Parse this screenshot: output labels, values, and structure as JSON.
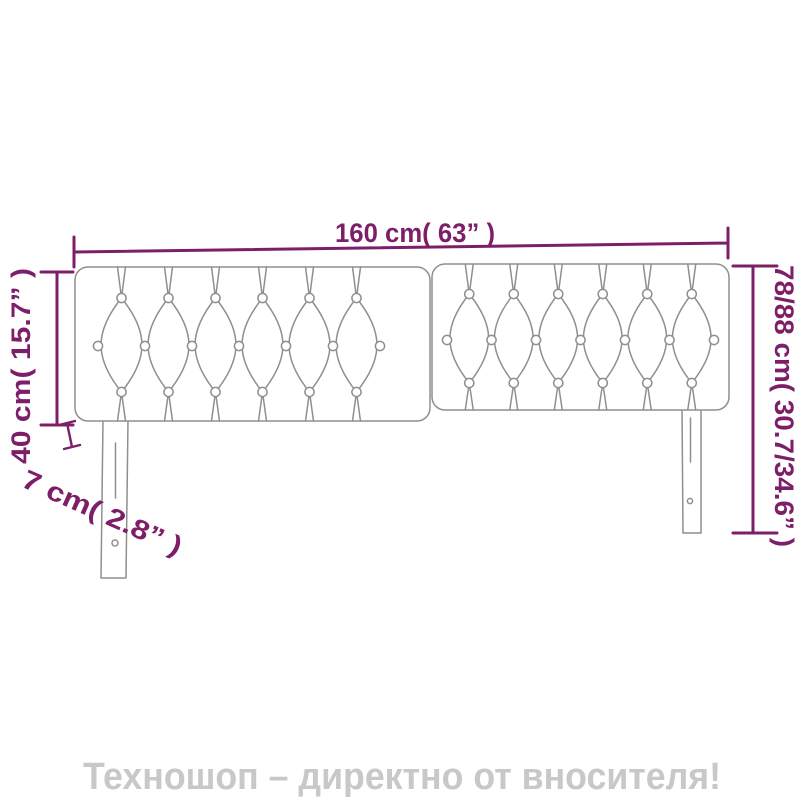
{
  "dimensions": {
    "width_label": "160 cm( 63” )",
    "height_label": "78/88 cm( 30.7/34.6” )",
    "panel_height_label": "40 cm( 15.7” )",
    "depth_label": "7 cm( 2.8” )"
  },
  "watermark": {
    "text": "Техношоп – директно от вносителя!"
  },
  "colors": {
    "dimension_accent": "#7D1E69",
    "drawing_line": "#8F8F8F",
    "watermark_text": "#C8C8C8",
    "background": "#FFFFFF"
  }
}
